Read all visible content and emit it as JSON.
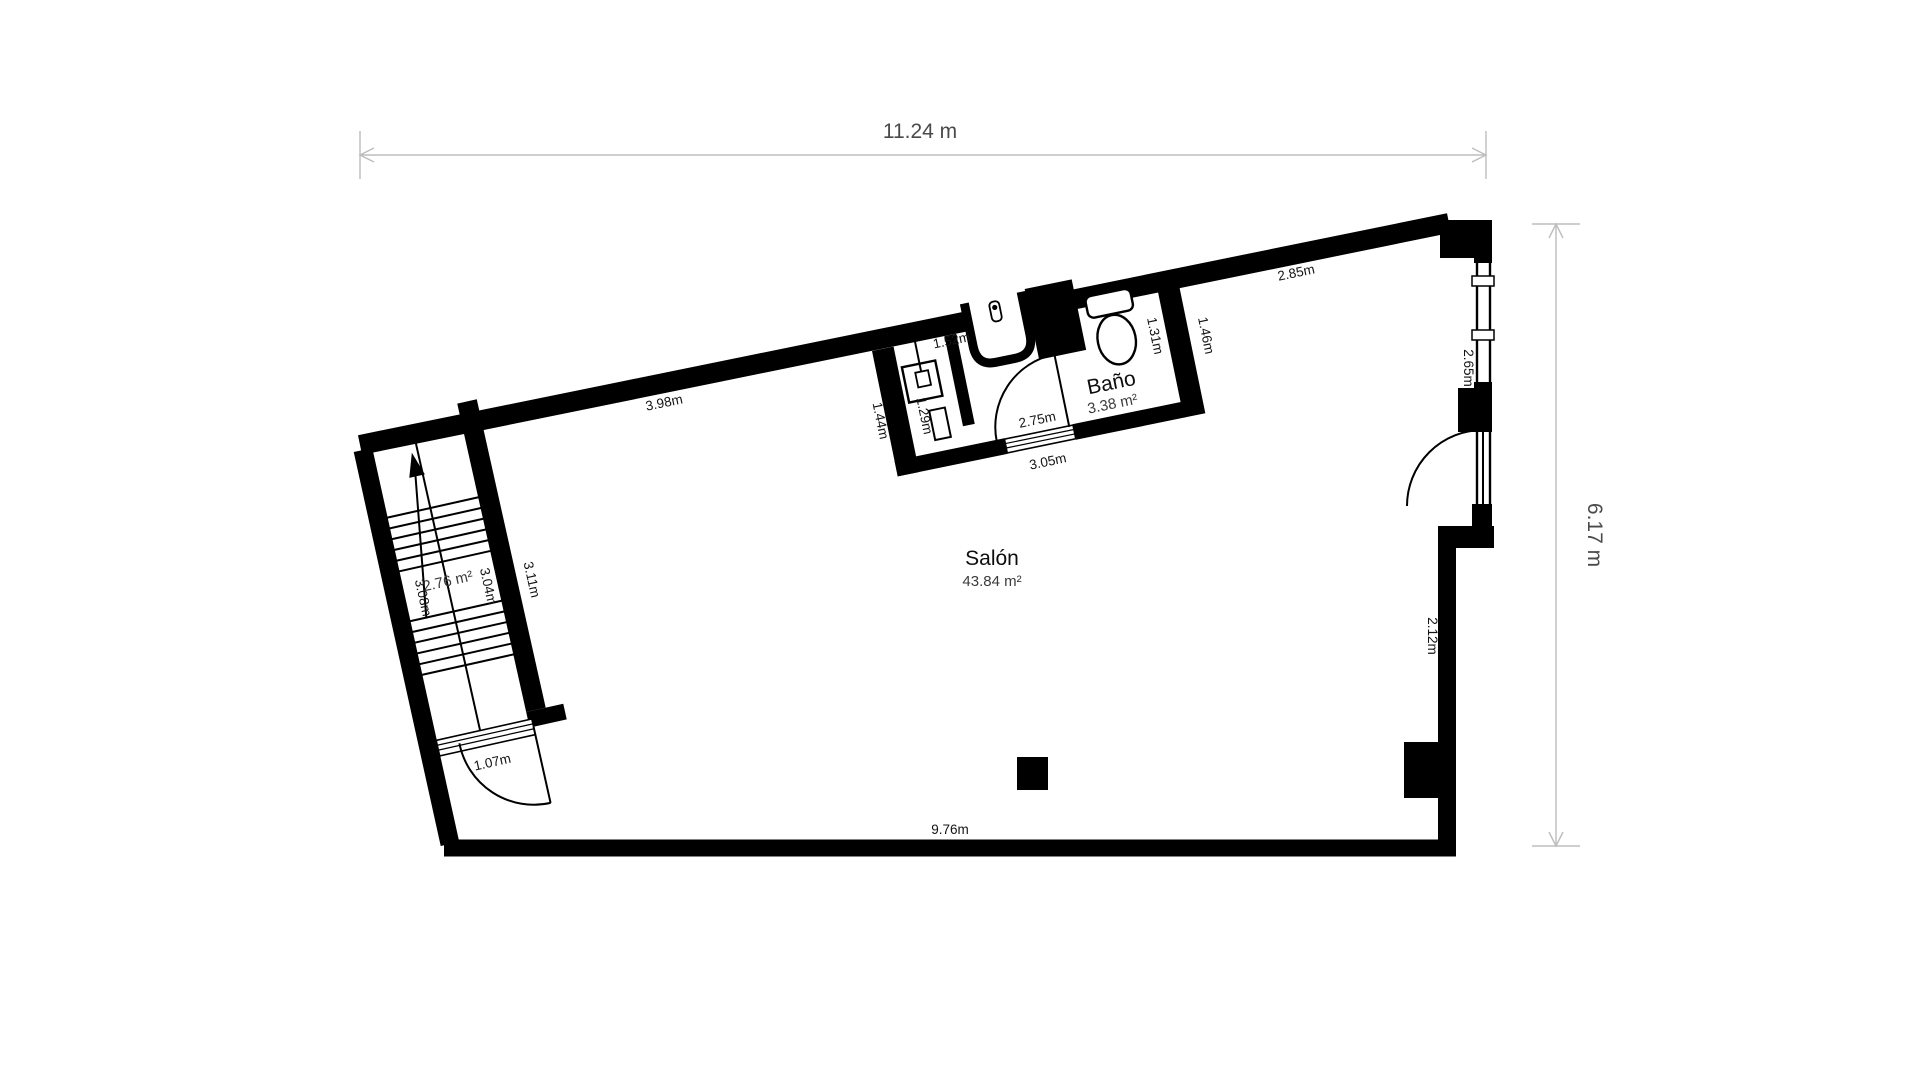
{
  "plan": {
    "dimensions": {
      "width_total": "11.24 m",
      "height_total": "6.17 m"
    },
    "rooms": {
      "salon": {
        "name": "Salón",
        "area": "43.84 m²"
      },
      "bano": {
        "name": "Baño",
        "area": "3.38 m²"
      },
      "stairs": {
        "area": "2.76 m²"
      }
    },
    "measurements": {
      "top_wall_left": "3.98m",
      "top_wall_right": "2.85m",
      "bottom_wall": "9.76m",
      "stairs_left": "3.08m",
      "stairs_inner": "3.04m",
      "stairs_outer": "3.11m",
      "stairs_door": "1.07m",
      "bath_outer_left": "1.44m",
      "bath_inner_left": "1.29m",
      "bath_top": "1.52m",
      "bath_inner_right": "1.31m",
      "bath_outer_right": "1.46m",
      "bath_door": "2.75m",
      "bath_bottom": "3.05m",
      "right_window": "2.65m",
      "right_wall_lower": "2.12m"
    },
    "fixtures": [
      "stair-arrow",
      "sink-square",
      "washbasin",
      "duct",
      "toilet",
      "column"
    ],
    "colors": {
      "wall": "#000000",
      "background": "#ffffff",
      "dimension_line": "#bdbdbd",
      "dimension_text": "#4a4a4a",
      "label_text": "#141414"
    }
  }
}
